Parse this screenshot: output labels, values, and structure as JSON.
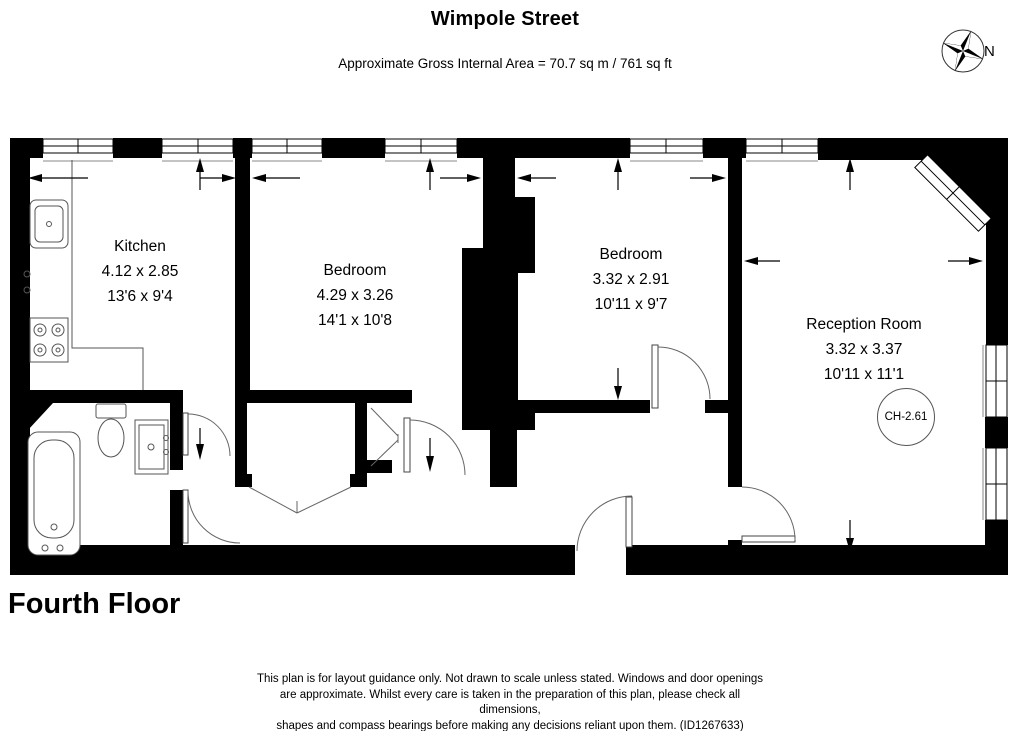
{
  "header": {
    "title": "Wimpole Street",
    "area_line": "Approximate Gross Internal Area = 70.7 sq m / 761 sq ft"
  },
  "compass": {
    "label": "N"
  },
  "floor_label": "Fourth Floor",
  "rooms": {
    "kitchen": {
      "name": "Kitchen",
      "metric": "4.12 x 2.85",
      "imperial": "13'6 x 9'4"
    },
    "bedroom1": {
      "name": "Bedroom",
      "metric": "4.29 x 3.26",
      "imperial": "14'1 x 10'8"
    },
    "bedroom2": {
      "name": "Bedroom",
      "metric": "3.32 x 2.91",
      "imperial": "10'11 x 9'7"
    },
    "reception": {
      "name": "Reception Room",
      "metric": "3.32 x 3.37",
      "imperial": "10'11 x 11'1",
      "ceiling_height": "CH-2.61"
    }
  },
  "disclaimer": {
    "lines": [
      "This plan is for layout guidance only. Not drawn to scale unless stated. Windows and door openings",
      "are approximate. Whilst every care is taken in the preparation of this plan, please check all dimensions,",
      "shapes and compass bearings before making any decisions reliant upon them. (ID1267633)"
    ]
  },
  "colors": {
    "wall": "#000000",
    "line": "#555555",
    "background": "#ffffff"
  }
}
